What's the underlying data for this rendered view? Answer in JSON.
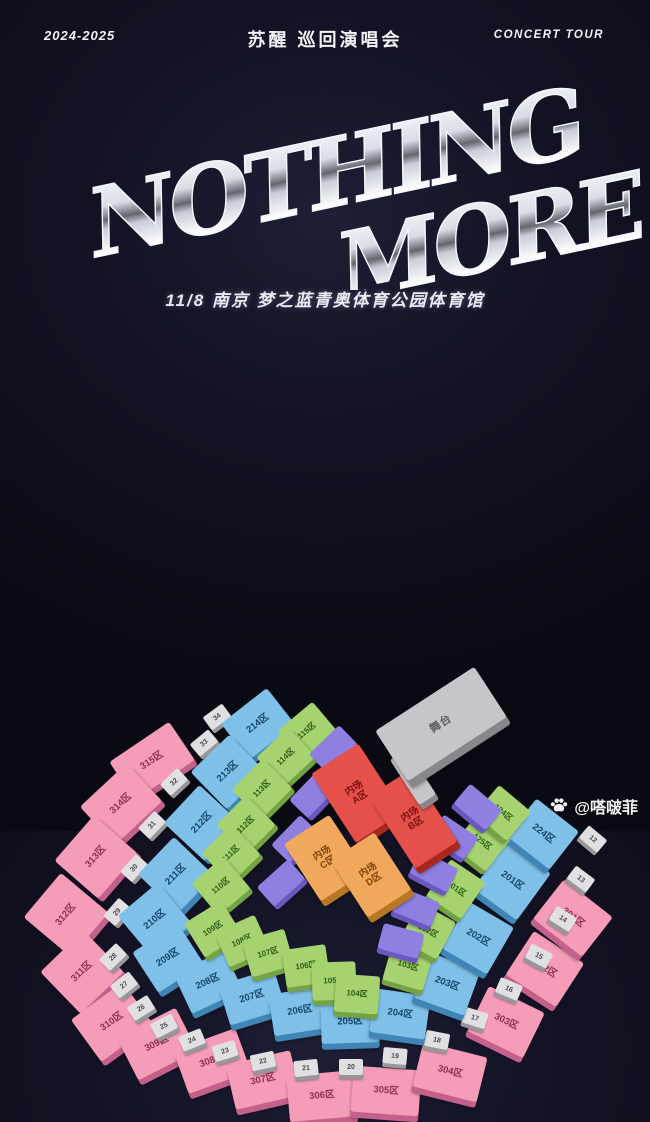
{
  "header": {
    "left": "2024-2025",
    "center": "苏醒 巡回演唱会",
    "right": "CONCERT TOUR"
  },
  "logo": {
    "line1": "NOTHING",
    "line2": "MORE"
  },
  "subtitle": "11/8 南京 梦之蓝青奥体育公园体育馆",
  "watermark": {
    "icon": "paw-icon",
    "handle": "@嗒啵菲"
  },
  "colors": {
    "background": "#0d0d18",
    "pink": "#f59cb8",
    "blue": "#7fc0e8",
    "green": "#a6d36f",
    "purple": "#8f7fe0",
    "red": "#e5504a",
    "orange": "#f0a95c",
    "gate": "#e0e0e3",
    "stage": "#c6c6ca"
  },
  "map": {
    "stage": {
      "label": "舞台",
      "x": 441,
      "y": 394,
      "w": 118,
      "h": 60,
      "r": -33
    },
    "runway": {
      "x": 413,
      "y": 447,
      "w": 20,
      "h": 54,
      "r": -33
    },
    "floor": [
      {
        "lines": [
          "内场",
          "A区"
        ],
        "x": 357,
        "y": 463,
        "w": 56,
        "h": 82,
        "r": -33,
        "cls": "red"
      },
      {
        "lines": [
          "内场",
          "B区"
        ],
        "x": 413,
        "y": 489,
        "w": 50,
        "h": 86,
        "r": -33,
        "cls": "red"
      },
      {
        "lines": [
          "内场",
          "C区"
        ],
        "x": 325,
        "y": 528,
        "w": 54,
        "h": 68,
        "r": -33,
        "cls": "orange"
      },
      {
        "lines": [
          "内场",
          "D区"
        ],
        "x": 371,
        "y": 545,
        "w": 52,
        "h": 68,
        "r": -33,
        "cls": "orange"
      }
    ],
    "ring_pink": [
      {
        "label": "315区",
        "x": 152,
        "y": 431,
        "r": -34,
        "w": 72,
        "h": 46
      },
      {
        "label": "314区",
        "x": 121,
        "y": 474,
        "r": -43,
        "w": 64,
        "h": 52
      },
      {
        "label": "313区",
        "x": 96,
        "y": 527,
        "r": -49,
        "w": 60,
        "h": 58
      },
      {
        "label": "312区",
        "x": 66,
        "y": 585,
        "r": -50,
        "w": 58,
        "h": 62
      },
      {
        "label": "311区",
        "x": 82,
        "y": 642,
        "r": -44,
        "w": 60,
        "h": 58
      },
      {
        "label": "310区",
        "x": 112,
        "y": 692,
        "r": -36,
        "w": 64,
        "h": 52
      },
      {
        "label": "309区",
        "x": 157,
        "y": 714,
        "r": -27,
        "w": 66,
        "h": 48
      },
      {
        "label": "308区",
        "x": 212,
        "y": 731,
        "r": -20,
        "w": 66,
        "h": 46
      },
      {
        "label": "307区",
        "x": 263,
        "y": 750,
        "r": -13,
        "w": 66,
        "h": 46
      },
      {
        "label": "306区",
        "x": 322,
        "y": 766,
        "r": -5,
        "w": 68,
        "h": 46
      },
      {
        "label": "305区",
        "x": 386,
        "y": 761,
        "r": 4,
        "w": 68,
        "h": 46
      },
      {
        "label": "304区",
        "x": 450,
        "y": 742,
        "r": 14,
        "w": 66,
        "h": 46
      },
      {
        "label": "303区",
        "x": 506,
        "y": 692,
        "r": 26,
        "w": 62,
        "h": 50
      },
      {
        "label": "302区",
        "x": 545,
        "y": 639,
        "r": 33,
        "w": 60,
        "h": 52
      },
      {
        "label": "301区",
        "x": 573,
        "y": 588,
        "r": 38,
        "w": 62,
        "h": 50
      }
    ],
    "ring_blue": [
      {
        "label": "214区",
        "x": 258,
        "y": 394,
        "r": -38,
        "w": 58,
        "h": 46
      },
      {
        "label": "213区",
        "x": 228,
        "y": 442,
        "r": -44,
        "w": 54,
        "h": 52
      },
      {
        "label": "212区",
        "x": 202,
        "y": 493,
        "r": -47,
        "w": 52,
        "h": 56
      },
      {
        "label": "211区",
        "x": 176,
        "y": 545,
        "r": -46,
        "w": 52,
        "h": 56
      },
      {
        "label": "210区",
        "x": 155,
        "y": 590,
        "r": -40,
        "w": 52,
        "h": 54
      },
      {
        "label": "209区",
        "x": 168,
        "y": 628,
        "r": -33,
        "w": 54,
        "h": 48
      },
      {
        "label": "208区",
        "x": 208,
        "y": 652,
        "r": -25,
        "w": 56,
        "h": 44
      },
      {
        "label": "207区",
        "x": 252,
        "y": 667,
        "r": -17,
        "w": 58,
        "h": 42
      },
      {
        "label": "206区",
        "x": 300,
        "y": 681,
        "r": -9,
        "w": 58,
        "h": 42
      },
      {
        "label": "205区",
        "x": 350,
        "y": 692,
        "r": -2,
        "w": 58,
        "h": 42
      },
      {
        "label": "204区",
        "x": 400,
        "y": 684,
        "r": 8,
        "w": 56,
        "h": 44
      },
      {
        "label": "203区",
        "x": 447,
        "y": 654,
        "r": 20,
        "w": 54,
        "h": 48
      },
      {
        "label": "202区",
        "x": 478,
        "y": 608,
        "r": 30,
        "w": 52,
        "h": 54
      },
      {
        "label": "201区",
        "x": 512,
        "y": 551,
        "r": 36,
        "w": 54,
        "h": 58
      },
      {
        "label": "224区",
        "x": 543,
        "y": 504,
        "r": 38,
        "w": 54,
        "h": 48
      }
    ],
    "ring_green": [
      {
        "label": "115区",
        "x": 307,
        "y": 401,
        "r": -40,
        "w": 46,
        "h": 38
      },
      {
        "label": "114区",
        "x": 286,
        "y": 427,
        "r": -43,
        "w": 44,
        "h": 40
      },
      {
        "label": "113区",
        "x": 262,
        "y": 459,
        "r": -45,
        "w": 44,
        "h": 42
      },
      {
        "label": "112区",
        "x": 246,
        "y": 495,
        "r": -45,
        "w": 42,
        "h": 42
      },
      {
        "label": "111区",
        "x": 231,
        "y": 524,
        "r": -44,
        "w": 42,
        "h": 42
      },
      {
        "label": "110区",
        "x": 221,
        "y": 556,
        "r": -40,
        "w": 42,
        "h": 42
      },
      {
        "label": "109区",
        "x": 213,
        "y": 599,
        "r": -32,
        "w": 44,
        "h": 40
      },
      {
        "label": "108区",
        "x": 242,
        "y": 611,
        "r": -24,
        "w": 44,
        "h": 38
      },
      {
        "label": "107区",
        "x": 268,
        "y": 623,
        "r": -16,
        "w": 44,
        "h": 38
      },
      {
        "label": "106区",
        "x": 306,
        "y": 636,
        "r": -8,
        "w": 44,
        "h": 38
      },
      {
        "label": "105区",
        "x": 334,
        "y": 651,
        "r": -2,
        "w": 44,
        "h": 38
      },
      {
        "label": "104区",
        "x": 357,
        "y": 664,
        "r": 4,
        "w": 44,
        "h": 38
      },
      {
        "label": "103区",
        "x": 408,
        "y": 636,
        "r": 16,
        "w": 42,
        "h": 40
      },
      {
        "label": "102区",
        "x": 428,
        "y": 601,
        "r": 28,
        "w": 42,
        "h": 42
      },
      {
        "label": "101区",
        "x": 456,
        "y": 559,
        "r": 34,
        "w": 42,
        "h": 44
      },
      {
        "label": "125区",
        "x": 482,
        "y": 512,
        "r": 38,
        "w": 42,
        "h": 42
      },
      {
        "label": "124区",
        "x": 503,
        "y": 483,
        "r": 40,
        "w": 42,
        "h": 38
      }
    ],
    "ring_purple": [
      {
        "x": 333,
        "y": 419,
        "r": -44
      },
      {
        "x": 313,
        "y": 464,
        "r": -46
      },
      {
        "x": 295,
        "y": 509,
        "r": -46
      },
      {
        "x": 281,
        "y": 553,
        "r": -42
      },
      {
        "x": 478,
        "y": 477,
        "r": 40
      },
      {
        "x": 454,
        "y": 507,
        "r": 34
      },
      {
        "x": 434,
        "y": 541,
        "r": 28
      },
      {
        "x": 416,
        "y": 577,
        "r": 22
      },
      {
        "x": 401,
        "y": 611,
        "r": 15
      }
    ],
    "gates": [
      {
        "label": "12",
        "x": 593,
        "y": 509,
        "r": 40
      },
      {
        "label": "13",
        "x": 581,
        "y": 549,
        "r": 37
      },
      {
        "label": "14",
        "x": 563,
        "y": 589,
        "r": 33
      },
      {
        "label": "15",
        "x": 539,
        "y": 626,
        "r": 28
      },
      {
        "label": "16",
        "x": 509,
        "y": 659,
        "r": 23
      },
      {
        "label": "17",
        "x": 475,
        "y": 688,
        "r": 17
      },
      {
        "label": "18",
        "x": 437,
        "y": 710,
        "r": 11
      },
      {
        "label": "19",
        "x": 395,
        "y": 726,
        "r": 5
      },
      {
        "label": "20",
        "x": 351,
        "y": 737,
        "r": 0
      },
      {
        "label": "21",
        "x": 306,
        "y": 738,
        "r": -6
      },
      {
        "label": "22",
        "x": 263,
        "y": 731,
        "r": -12
      },
      {
        "label": "23",
        "x": 225,
        "y": 721,
        "r": -17
      },
      {
        "label": "24",
        "x": 192,
        "y": 710,
        "r": -22
      },
      {
        "label": "25",
        "x": 164,
        "y": 696,
        "r": -27
      },
      {
        "label": "26",
        "x": 141,
        "y": 678,
        "r": -32
      },
      {
        "label": "27",
        "x": 124,
        "y": 655,
        "r": -38
      },
      {
        "label": "28",
        "x": 113,
        "y": 627,
        "r": -44
      },
      {
        "label": "29",
        "x": 117,
        "y": 582,
        "r": -49
      },
      {
        "label": "30",
        "x": 134,
        "y": 538,
        "r": -48
      },
      {
        "label": "31",
        "x": 152,
        "y": 495,
        "r": -46
      },
      {
        "label": "32",
        "x": 174,
        "y": 452,
        "r": -43
      },
      {
        "label": "33",
        "x": 204,
        "y": 413,
        "r": -40
      },
      {
        "label": "34",
        "x": 217,
        "y": 387,
        "r": -36
      }
    ]
  }
}
